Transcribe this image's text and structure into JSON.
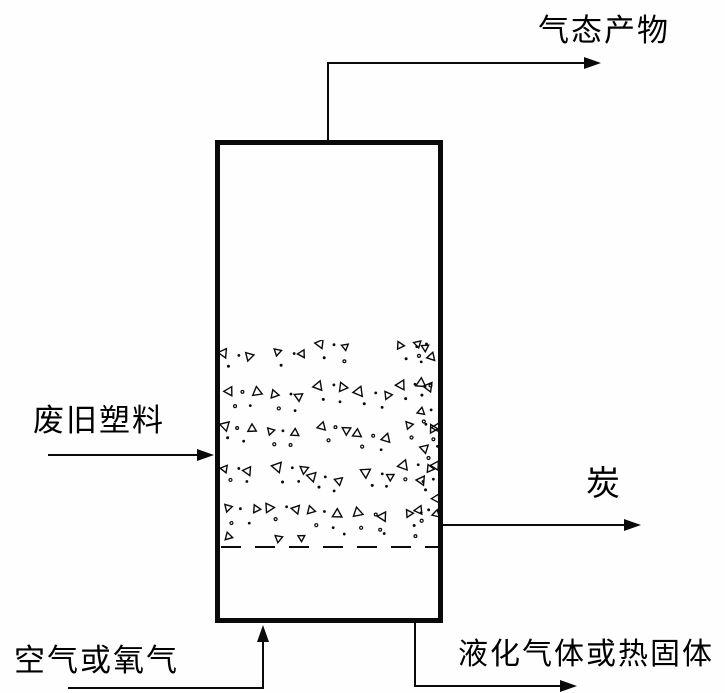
{
  "diagram": {
    "name": "fluidized-bed-reactor-flow-diagram",
    "background_color": "#fefefe",
    "line_color": "#0a0a0a",
    "labels": {
      "top_outlet": "气态产物",
      "left_inlet": "废旧塑料",
      "right_outlet": "炭",
      "bottom_inlet": "空气或氧气",
      "bottom_outlet": "液化气体或热固体"
    },
    "vessel": {
      "shape": "rectangle",
      "border_px": 5,
      "x": 215,
      "y": 140,
      "w": 228,
      "h": 483
    },
    "bed": {
      "symbols": [
        "open-triangle",
        "dot"
      ],
      "region": {
        "x": 220,
        "y": 340,
        "w": 219,
        "h": 207
      },
      "cluster_rows": 5,
      "cluster_cols": 5,
      "row_spacing": 40,
      "col_spacing": 44,
      "edge_column_clusters": 6,
      "seed": 1337
    },
    "bed_surface_line": {
      "style": "dashed",
      "y": 547
    }
  }
}
